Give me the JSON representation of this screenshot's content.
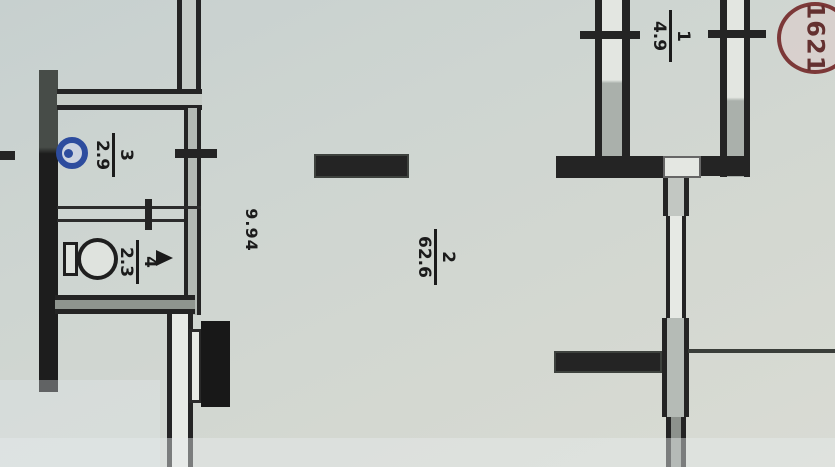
{
  "plan": {
    "stamp": {
      "number": "1621"
    },
    "rooms": [
      {
        "id": "room-1",
        "number": "1",
        "area": "4.9"
      },
      {
        "id": "room-2",
        "number": "2",
        "area": "62.6"
      },
      {
        "id": "room-3",
        "number": "3",
        "area": "2.9"
      },
      {
        "id": "room-4",
        "number": "4",
        "area": "2.3"
      }
    ],
    "dimensions": {
      "room2_length": "9.94"
    },
    "icons": {
      "sink": "sink-icon",
      "toilet": "toilet-icon",
      "door_arrow": "door-arrow-icon",
      "stamp": "stamp-circle-icon"
    },
    "colors": {
      "paper": "#cfd6d2",
      "wall": "#242424",
      "stamp_red": "#7c3838",
      "fixture_blue": "#2d4c9e"
    }
  }
}
